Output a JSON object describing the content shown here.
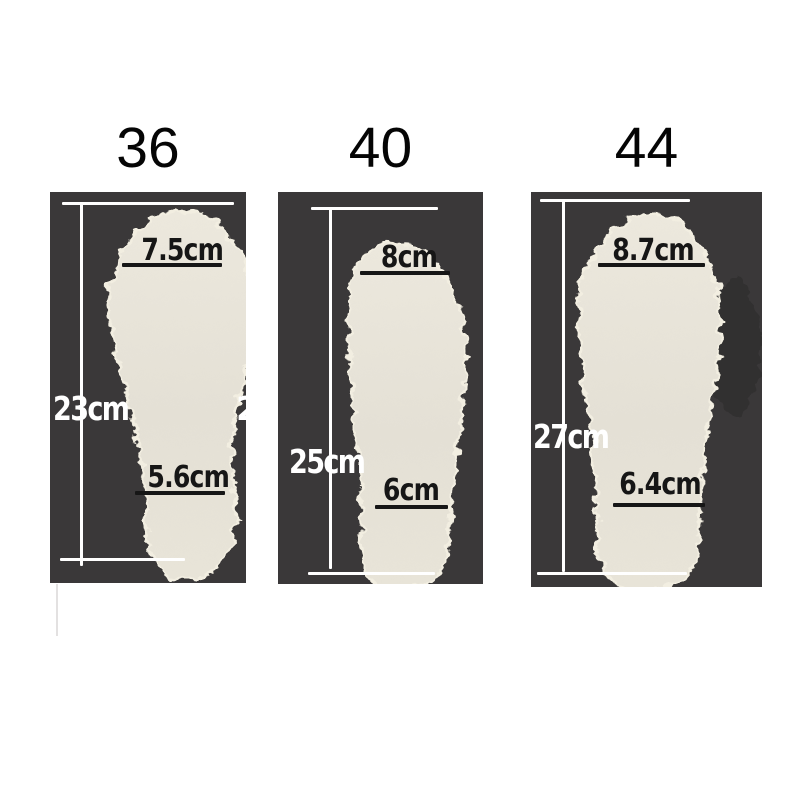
{
  "title": "Insole size measurement chart",
  "panels": [
    {
      "size": "36",
      "length": "23cm",
      "toe_width": "7.5cm",
      "heel_width": "5.6cm",
      "clipped_char": "2"
    },
    {
      "size": "40",
      "length": "25cm",
      "toe_width": "8cm",
      "heel_width": "6cm"
    },
    {
      "size": "44",
      "length": "27cm",
      "toe_width": "8.7cm",
      "heel_width": "6.4cm"
    }
  ],
  "colors": {
    "page_background": "#ffffff",
    "panel_background": "#3a3839",
    "insole_body": "#e6e2d7",
    "insole_fluff": "#f2eee1",
    "measure_line_light": "#ffffff",
    "measure_line_dark": "#161616",
    "size_number_text": "#050505"
  }
}
